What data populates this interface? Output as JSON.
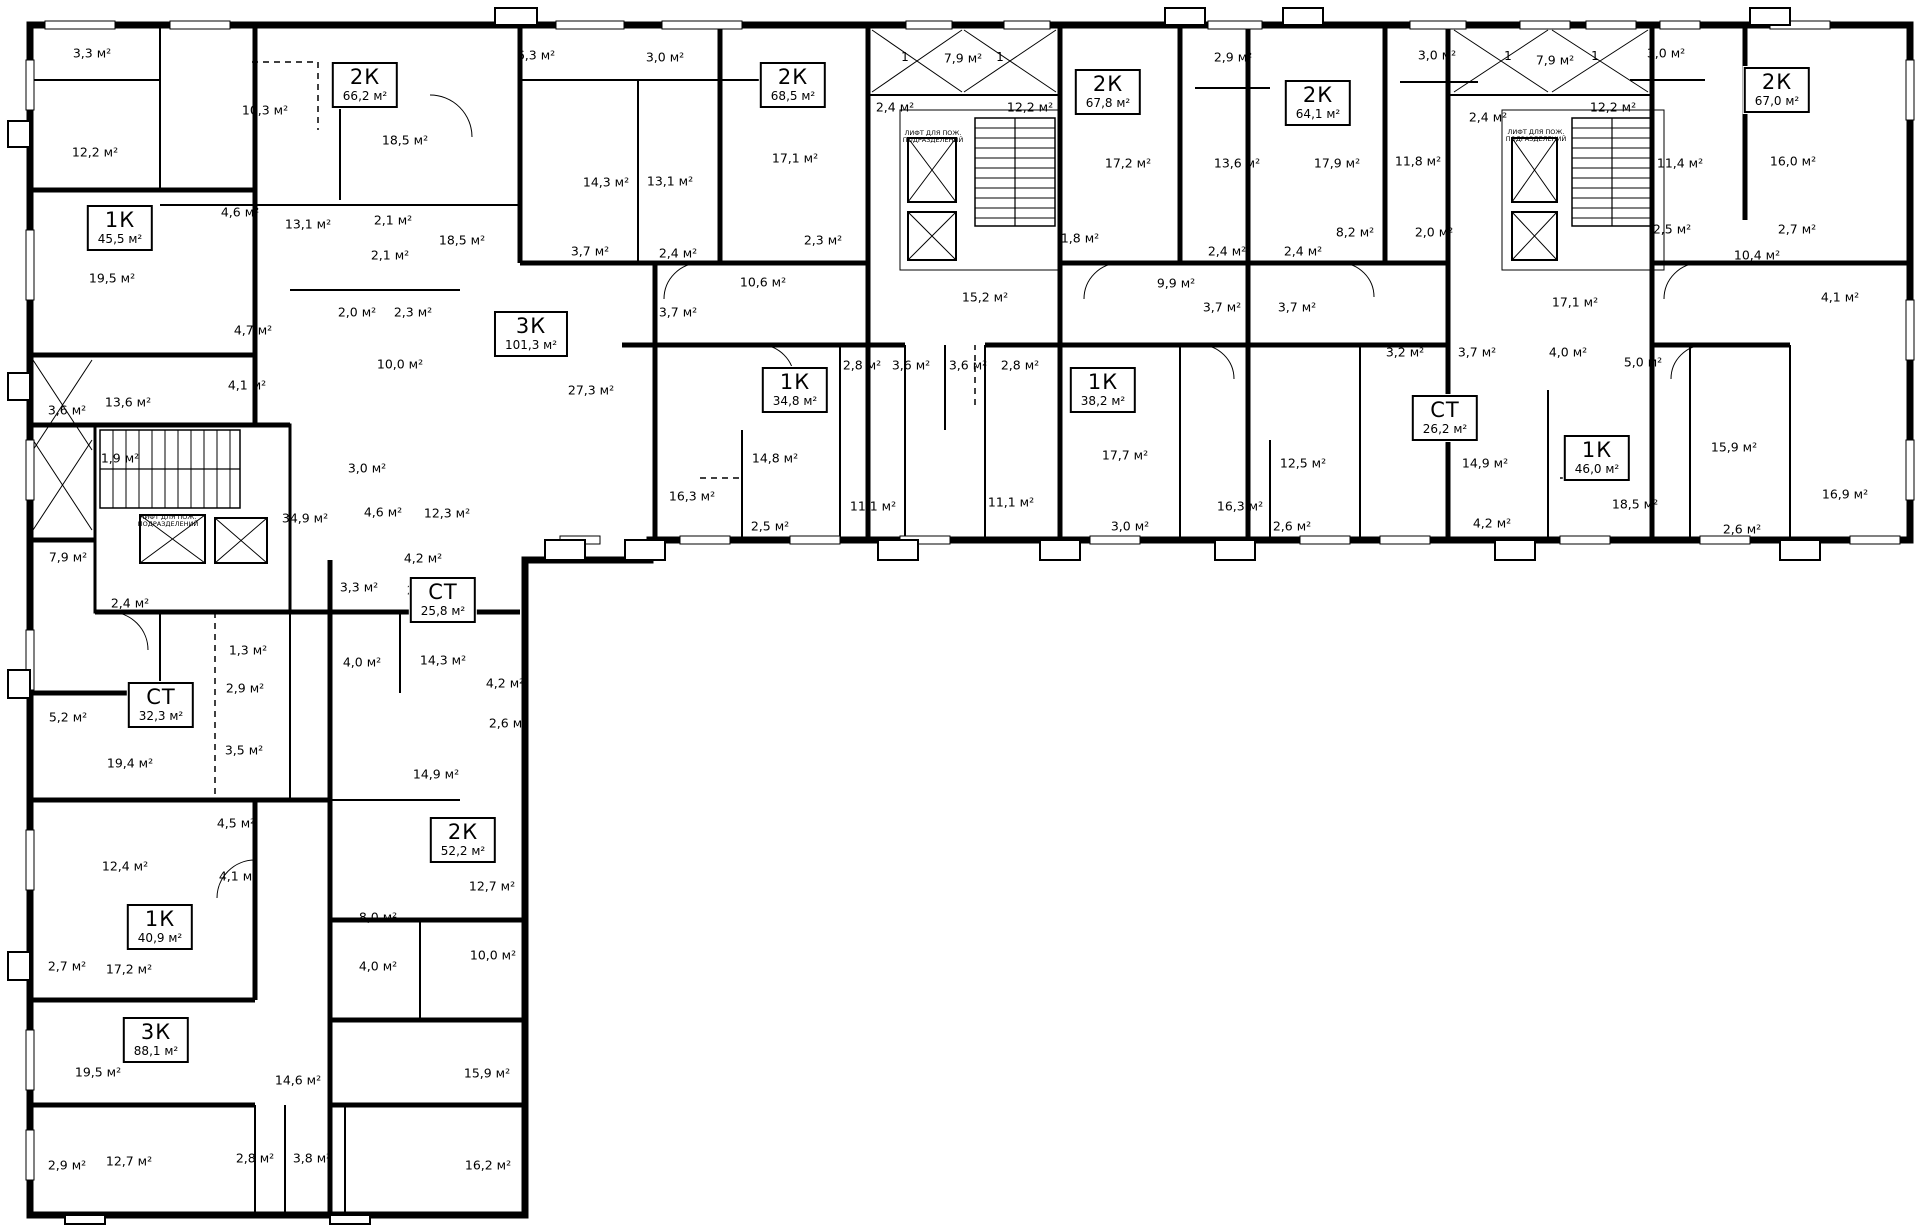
{
  "meta": {
    "drawing_type": "residential floor plan",
    "wall_color": "#000000",
    "background": "#ffffff",
    "area_unit": "м²"
  },
  "units": [
    {
      "type": "1К",
      "area": "45,5 м²",
      "x": 120,
      "y": 228
    },
    {
      "type": "2К",
      "area": "66,2 м²",
      "x": 365,
      "y": 85
    },
    {
      "type": "2К",
      "area": "68,5 м²",
      "x": 793,
      "y": 85
    },
    {
      "type": "2К",
      "area": "67,8 м²",
      "x": 1108,
      "y": 92
    },
    {
      "type": "2К",
      "area": "64,1 м²",
      "x": 1318,
      "y": 103
    },
    {
      "type": "2К",
      "area": "67,0 м²",
      "x": 1777,
      "y": 90
    },
    {
      "type": "3К",
      "area": "101,3 м²",
      "x": 531,
      "y": 334
    },
    {
      "type": "1К",
      "area": "34,8 м²",
      "x": 795,
      "y": 390
    },
    {
      "type": "1К",
      "area": "38,2 м²",
      "x": 1103,
      "y": 390
    },
    {
      "type": "СТ",
      "area": "26,2 м²",
      "x": 1445,
      "y": 418
    },
    {
      "type": "1К",
      "area": "46,0 м²",
      "x": 1597,
      "y": 458
    },
    {
      "type": "СТ",
      "area": "25,8 м²",
      "x": 443,
      "y": 600
    },
    {
      "type": "СТ",
      "area": "32,3 м²",
      "x": 161,
      "y": 705
    },
    {
      "type": "2К",
      "area": "52,2 м²",
      "x": 463,
      "y": 840
    },
    {
      "type": "1К",
      "area": "40,9 м²",
      "x": 160,
      "y": 927
    },
    {
      "type": "3К",
      "area": "88,1 м²",
      "x": 156,
      "y": 1040
    }
  ],
  "rooms": [
    {
      "t": "3,3 м²",
      "x": 92,
      "y": 53
    },
    {
      "t": "10,3 м²",
      "x": 265,
      "y": 110
    },
    {
      "t": "12,2 м²",
      "x": 95,
      "y": 152
    },
    {
      "t": "18,5 м²",
      "x": 405,
      "y": 140
    },
    {
      "t": "4,6 м²",
      "x": 240,
      "y": 212
    },
    {
      "t": "13,1 м²",
      "x": 308,
      "y": 224
    },
    {
      "t": "2,1 м²",
      "x": 393,
      "y": 220
    },
    {
      "t": "2,1 м²",
      "x": 390,
      "y": 255
    },
    {
      "t": "18,5 м²",
      "x": 462,
      "y": 240
    },
    {
      "t": "19,5 м²",
      "x": 112,
      "y": 278
    },
    {
      "t": "2,0 м²",
      "x": 357,
      "y": 312
    },
    {
      "t": "2,3 м²",
      "x": 413,
      "y": 312
    },
    {
      "t": "6,3 м²",
      "x": 536,
      "y": 55
    },
    {
      "t": "3,0 м²",
      "x": 665,
      "y": 57
    },
    {
      "t": "14,3 м²",
      "x": 606,
      "y": 182
    },
    {
      "t": "13,1 м²",
      "x": 670,
      "y": 181
    },
    {
      "t": "17,1 м²",
      "x": 795,
      "y": 158
    },
    {
      "t": "2,3 м²",
      "x": 823,
      "y": 240
    },
    {
      "t": "3,7 м²",
      "x": 590,
      "y": 251
    },
    {
      "t": "2,4 м²",
      "x": 678,
      "y": 253
    },
    {
      "t": "3,7 м²",
      "x": 678,
      "y": 312
    },
    {
      "t": "10,6 м²",
      "x": 763,
      "y": 282
    },
    {
      "t": "27,3 м²",
      "x": 591,
      "y": 390
    },
    {
      "t": "2,8 м²",
      "x": 862,
      "y": 365
    },
    {
      "t": "3,6 м²",
      "x": 911,
      "y": 365
    },
    {
      "t": "16,3 м²",
      "x": 692,
      "y": 496
    },
    {
      "t": "14,8 м²",
      "x": 775,
      "y": 458
    },
    {
      "t": "2,5 м²",
      "x": 770,
      "y": 526
    },
    {
      "t": "11,1 м²",
      "x": 873,
      "y": 506
    },
    {
      "t": "7,9 м²",
      "x": 963,
      "y": 58
    },
    {
      "t": "2,4 м²",
      "x": 895,
      "y": 107
    },
    {
      "t": "12,2 м²",
      "x": 1030,
      "y": 107
    },
    {
      "t": "1,8 м²",
      "x": 1080,
      "y": 238
    },
    {
      "t": "15,2 м²",
      "x": 985,
      "y": 297
    },
    {
      "t": "3,6 м²",
      "x": 968,
      "y": 365
    },
    {
      "t": "2,8 м²",
      "x": 1020,
      "y": 365
    },
    {
      "t": "11,1 м²",
      "x": 1011,
      "y": 502
    },
    {
      "t": "2,9 м²",
      "x": 1233,
      "y": 57
    },
    {
      "t": "17,2 м²",
      "x": 1128,
      "y": 163
    },
    {
      "t": "13,6 м²",
      "x": 1237,
      "y": 163
    },
    {
      "t": "9,9 м²",
      "x": 1176,
      "y": 283
    },
    {
      "t": "2,4 м²",
      "x": 1227,
      "y": 251
    },
    {
      "t": "2,4 м²",
      "x": 1303,
      "y": 251
    },
    {
      "t": "3,7 м²",
      "x": 1222,
      "y": 307
    },
    {
      "t": "3,7 м²",
      "x": 1297,
      "y": 307
    },
    {
      "t": "17,7 м²",
      "x": 1125,
      "y": 455
    },
    {
      "t": "3,0 м²",
      "x": 1130,
      "y": 526
    },
    {
      "t": "16,3 м²",
      "x": 1240,
      "y": 506
    },
    {
      "t": "3,0 м²",
      "x": 1437,
      "y": 55
    },
    {
      "t": "17,9 м²",
      "x": 1337,
      "y": 163
    },
    {
      "t": "11,8 м²",
      "x": 1418,
      "y": 161
    },
    {
      "t": "8,2 м²",
      "x": 1355,
      "y": 232
    },
    {
      "t": "2,0 м²",
      "x": 1434,
      "y": 232
    },
    {
      "t": "12,5 м²",
      "x": 1303,
      "y": 463
    },
    {
      "t": "2,6 м²",
      "x": 1292,
      "y": 526
    },
    {
      "t": "3,2 м²",
      "x": 1405,
      "y": 352
    },
    {
      "t": "3,7 м²",
      "x": 1477,
      "y": 352
    },
    {
      "t": "14,9 м²",
      "x": 1485,
      "y": 463
    },
    {
      "t": "4,2 м²",
      "x": 1492,
      "y": 523
    },
    {
      "t": "7,9 м²",
      "x": 1555,
      "y": 60
    },
    {
      "t": "3,0 м²",
      "x": 1666,
      "y": 53
    },
    {
      "t": "2,4 м²",
      "x": 1488,
      "y": 117
    },
    {
      "t": "12,2 м²",
      "x": 1613,
      "y": 107
    },
    {
      "t": "11,4 м²",
      "x": 1680,
      "y": 163
    },
    {
      "t": "2,5 м²",
      "x": 1672,
      "y": 229
    },
    {
      "t": "17,1 м²",
      "x": 1575,
      "y": 302
    },
    {
      "t": "4,0 м²",
      "x": 1568,
      "y": 352
    },
    {
      "t": "5,0 м²",
      "x": 1643,
      "y": 362
    },
    {
      "t": "18,5 м²",
      "x": 1635,
      "y": 504
    },
    {
      "t": "2,6 м²",
      "x": 1742,
      "y": 529
    },
    {
      "t": "15,9 м²",
      "x": 1734,
      "y": 447
    },
    {
      "t": "16,0 м²",
      "x": 1793,
      "y": 161
    },
    {
      "t": "2,7 м²",
      "x": 1797,
      "y": 229
    },
    {
      "t": "10,4 м²",
      "x": 1757,
      "y": 255
    },
    {
      "t": "4,1 м²",
      "x": 1840,
      "y": 297
    },
    {
      "t": "16,9 м²",
      "x": 1845,
      "y": 494
    },
    {
      "t": "3,6 м²",
      "x": 67,
      "y": 410
    },
    {
      "t": "13,6 м²",
      "x": 128,
      "y": 402
    },
    {
      "t": "4,7 м²",
      "x": 253,
      "y": 330
    },
    {
      "t": "4,1 м²",
      "x": 247,
      "y": 385
    },
    {
      "t": "1,9 м²",
      "x": 120,
      "y": 458
    },
    {
      "t": "10,0 м²",
      "x": 400,
      "y": 364
    },
    {
      "t": "3,0 м²",
      "x": 367,
      "y": 468
    },
    {
      "t": "4,6 м²",
      "x": 383,
      "y": 512
    },
    {
      "t": "12,3 м²",
      "x": 447,
      "y": 513
    },
    {
      "t": "34,9 м²",
      "x": 305,
      "y": 518
    },
    {
      "t": "7,9 м²",
      "x": 68,
      "y": 557
    },
    {
      "t": "2,4 м²",
      "x": 130,
      "y": 603
    },
    {
      "t": "3,3 м²",
      "x": 359,
      "y": 587
    },
    {
      "t": "1,3 м²",
      "x": 248,
      "y": 650
    },
    {
      "t": "4,0 м²",
      "x": 362,
      "y": 662
    },
    {
      "t": "14,3 м²",
      "x": 443,
      "y": 660
    },
    {
      "t": "2,9 м²",
      "x": 245,
      "y": 688
    },
    {
      "t": "5,2 м²",
      "x": 68,
      "y": 717
    },
    {
      "t": "3,5 м²",
      "x": 244,
      "y": 750
    },
    {
      "t": "19,4 м²",
      "x": 130,
      "y": 763
    },
    {
      "t": "14,9 м²",
      "x": 436,
      "y": 774
    },
    {
      "t": "4,2 м²",
      "x": 423,
      "y": 558
    },
    {
      "t": "2,6 м²",
      "x": 426,
      "y": 590
    },
    {
      "t": "4,2 м²",
      "x": 505,
      "y": 683
    },
    {
      "t": "2,6 м²",
      "x": 508,
      "y": 723
    },
    {
      "t": "12,4 м²",
      "x": 125,
      "y": 866
    },
    {
      "t": "4,5 м²",
      "x": 236,
      "y": 823
    },
    {
      "t": "4,1 м²",
      "x": 238,
      "y": 876
    },
    {
      "t": "2,7 м²",
      "x": 67,
      "y": 966
    },
    {
      "t": "17,2 м²",
      "x": 129,
      "y": 969
    },
    {
      "t": "8,0 м²",
      "x": 378,
      "y": 917
    },
    {
      "t": "4,0 м²",
      "x": 378,
      "y": 966
    },
    {
      "t": "12,7 м²",
      "x": 492,
      "y": 886
    },
    {
      "t": "10,0 м²",
      "x": 493,
      "y": 955
    },
    {
      "t": "19,5 м²",
      "x": 98,
      "y": 1072
    },
    {
      "t": "14,6 м²",
      "x": 298,
      "y": 1080
    },
    {
      "t": "15,9 м²",
      "x": 487,
      "y": 1073
    },
    {
      "t": "2,9 м²",
      "x": 67,
      "y": 1165
    },
    {
      "t": "12,7 м²",
      "x": 129,
      "y": 1161
    },
    {
      "t": "2,8 м²",
      "x": 255,
      "y": 1158
    },
    {
      "t": "3,8 м²",
      "x": 312,
      "y": 1158
    },
    {
      "t": "16,2 м²",
      "x": 488,
      "y": 1165
    }
  ],
  "stair_marks": [
    {
      "t": "1",
      "x": 905,
      "y": 57
    },
    {
      "t": "1",
      "x": 1000,
      "y": 57
    },
    {
      "t": "1",
      "x": 1508,
      "y": 56
    },
    {
      "t": "1",
      "x": 1595,
      "y": 56
    }
  ],
  "core_labels": [
    {
      "t": "ЛИФТ ДЛЯ ПОЖ.\nПОДРАЗДЕЛЕНИЙ",
      "x": 168,
      "y": 521
    },
    {
      "t": "ЛИФТ ДЛЯ ПОЖ.\nПОДРАЗДЕЛЕНИЙ",
      "x": 933,
      "y": 137
    },
    {
      "t": "ЛИФТ ДЛЯ ПОЖ.\nПОДРАЗДЕЛЕНИЙ",
      "x": 1536,
      "y": 136
    }
  ]
}
